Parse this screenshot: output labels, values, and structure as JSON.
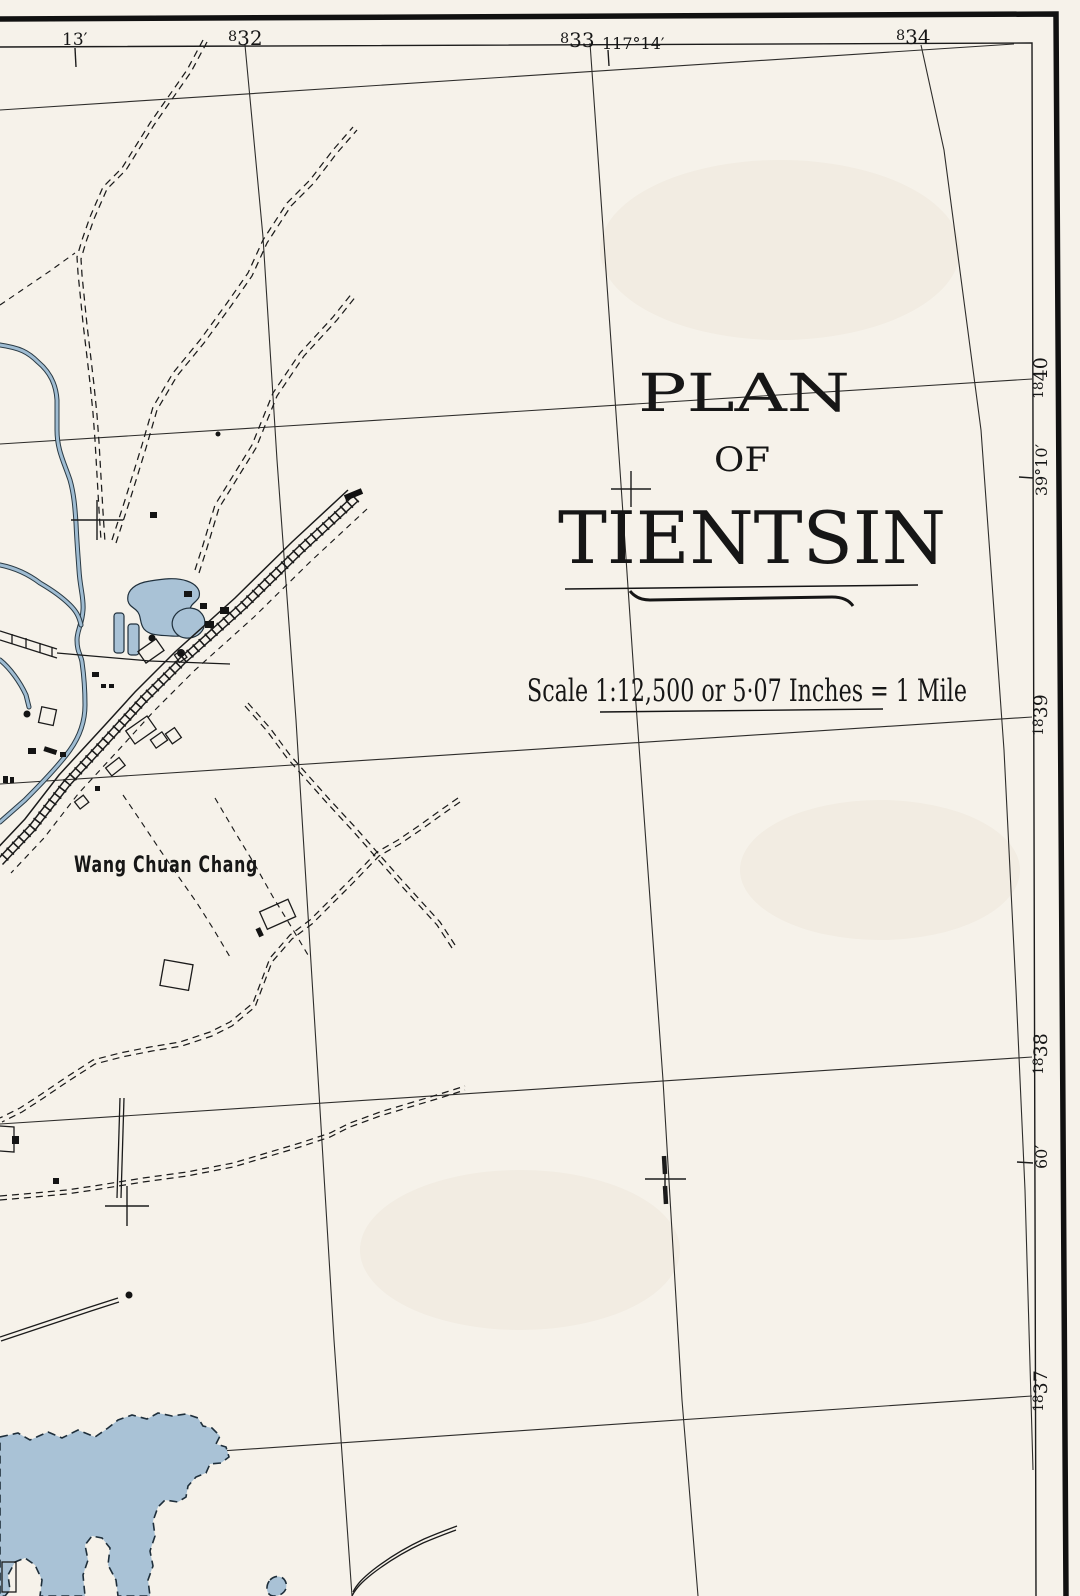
{
  "map": {
    "title": {
      "line1": "PLAN",
      "line2": "OF",
      "line3": "TIENTSIN"
    },
    "scale_label": "Scale 1:12,500 or 5·07 Inches = 1 Mile",
    "place_label": "Wang Chuan Chang",
    "top_labels": {
      "min13": "13′",
      "g832_small": "8",
      "g832_big": "32",
      "g833_small": "8",
      "g833_big": "33",
      "lon": "117°14′",
      "g834_small": "8",
      "g834_big": "34"
    },
    "right_labels": {
      "g1840_small": "18",
      "g1840_big": "40",
      "lat": "39°10′",
      "g1839_small": "18",
      "g1839_big": "39",
      "g1838_small": "18",
      "g1838_big": "38",
      "min60": "60′",
      "g1837_small": "18",
      "g1837_big": "37"
    },
    "colors": {
      "paper": "#f6f2ea",
      "ink": "#1c1c1c",
      "water_fill": "#a9c2d6",
      "canal_fill": "#9fbcd2"
    }
  }
}
